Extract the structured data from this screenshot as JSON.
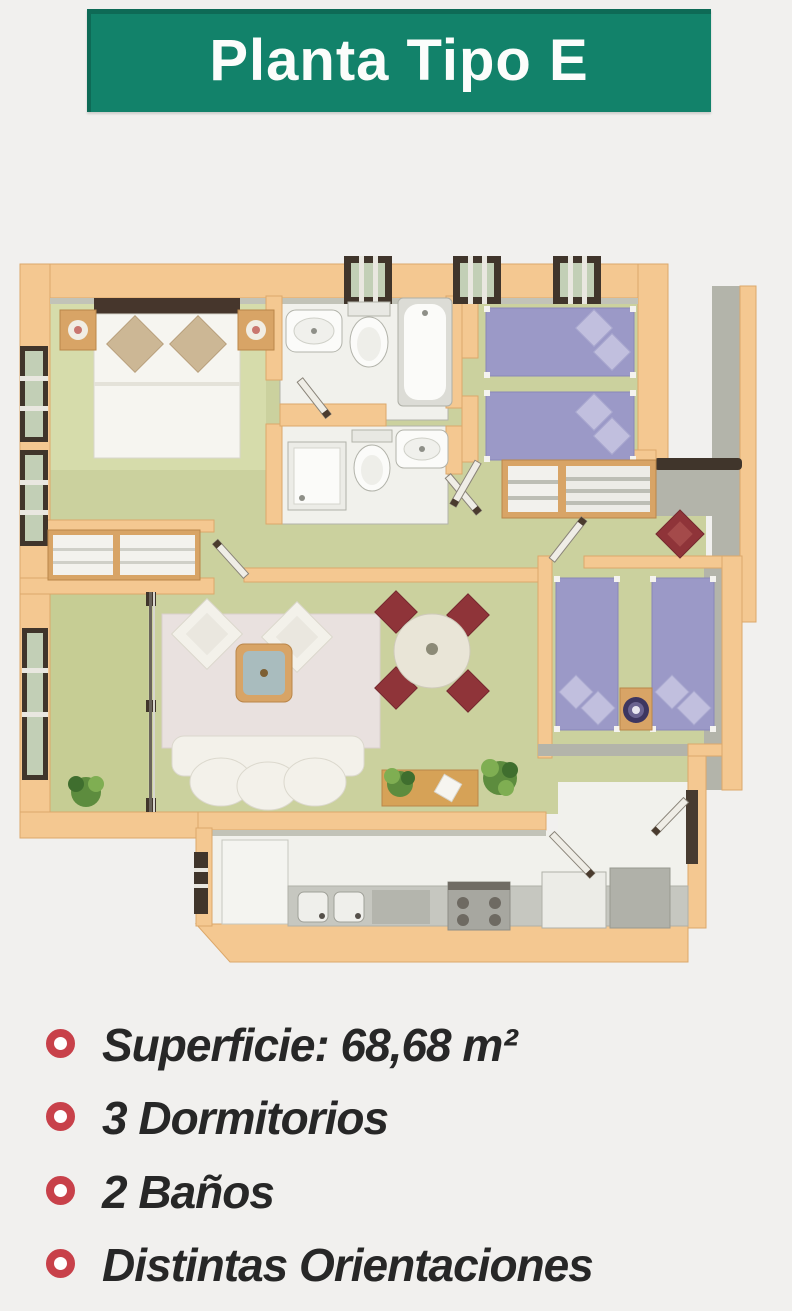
{
  "title": "Planta Tipo E",
  "features": [
    "Superficie: 68,68 m²",
    "3 Dormitorios",
    "2 Baños",
    "Distintas Orientaciones"
  ],
  "floor_plan": {
    "type": "apartment-floor-plan-3d-render",
    "rooms": [
      "dormitorio principal",
      "baño 1",
      "baño 2",
      "dormitorio 2",
      "dormitorio 3",
      "salón-comedor",
      "cocina",
      "terraza",
      "recibidor",
      "pasillo"
    ]
  },
  "colors": {
    "bg": "#f1f0ee",
    "banner": "#12826a",
    "red": "#c8414a",
    "ink": "#272727",
    "wall": "#f4c891",
    "wallEdge": "#dca86a",
    "wallGray": "#b3b4aa",
    "grayLip": "#c2c3b8",
    "floor": "#cbd19e",
    "floorLight": "#d6dcab",
    "terraceFloor": "#c6cd94",
    "white": "#f1f1ec",
    "fixture": "#d9d9d3",
    "fixStroke": "#b2b3aa",
    "purple": "#9b99c7",
    "purpleLight": "#c1bfde",
    "purpleStroke": "#8a88b8",
    "bedWhite": "#f6f5f0",
    "headboard": "#46362c",
    "pillowTan": "#ccb795",
    "wood": "#d8a466",
    "woodStroke": "#ba8649",
    "rug": "#e9e1df",
    "sofa": "#f3f1ea",
    "sofaStroke": "#dbd8cd",
    "tableTop": "#a9bcbe",
    "diningTable": "#e9e5d7",
    "chairRed": "#8f3439",
    "chairRedDark": "#74282e",
    "frame": "#40352b",
    "glass": "#c2cfb6",
    "counter": "#c6c7c0",
    "steel": "#a7a7a0",
    "burner": "#6e6a62",
    "plant": "#5d8c3e",
    "plantDark": "#3f6e2e",
    "plantLight": "#7fae52",
    "lamp": "#3d3660"
  }
}
